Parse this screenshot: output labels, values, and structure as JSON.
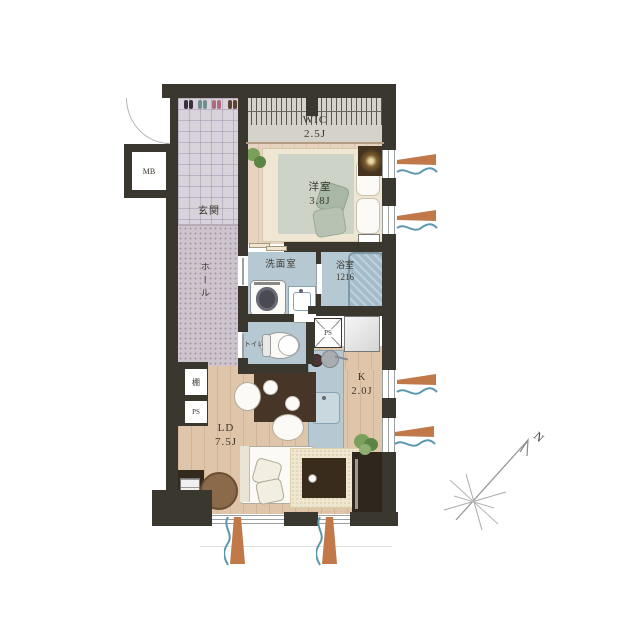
{
  "title": "apartment-floorplan",
  "rooms": {
    "wic": {
      "name": "WIC",
      "size": "2.5J"
    },
    "genkan": {
      "name": "玄関"
    },
    "bedroom": {
      "name": "洋室",
      "size": "3.8J"
    },
    "hall": {
      "name": "ホール"
    },
    "washroom": {
      "name": "洗面室"
    },
    "bathroom": {
      "name": "浴室",
      "size": "1216"
    },
    "toilet": {
      "name": "トイレ"
    },
    "kitchen": {
      "name": "K",
      "size": "2.0J"
    },
    "living_dining": {
      "name": "LD",
      "size": "7.5J"
    }
  },
  "labels": {
    "meter_box": "MB",
    "pipe_space": "PS",
    "shelf": "棚",
    "compass_north": "N"
  },
  "colors": {
    "wall": "#3a372e",
    "wood_floor": "#dfc5aa",
    "wet_floor": "#b6c8d2",
    "entry_tile": "#d8d2db",
    "hall_carpet": "#cdc4cd",
    "window_accent_orange": "#c1794a",
    "window_accent_blue": "#5b97ad",
    "plant_green": "#6f9254"
  }
}
